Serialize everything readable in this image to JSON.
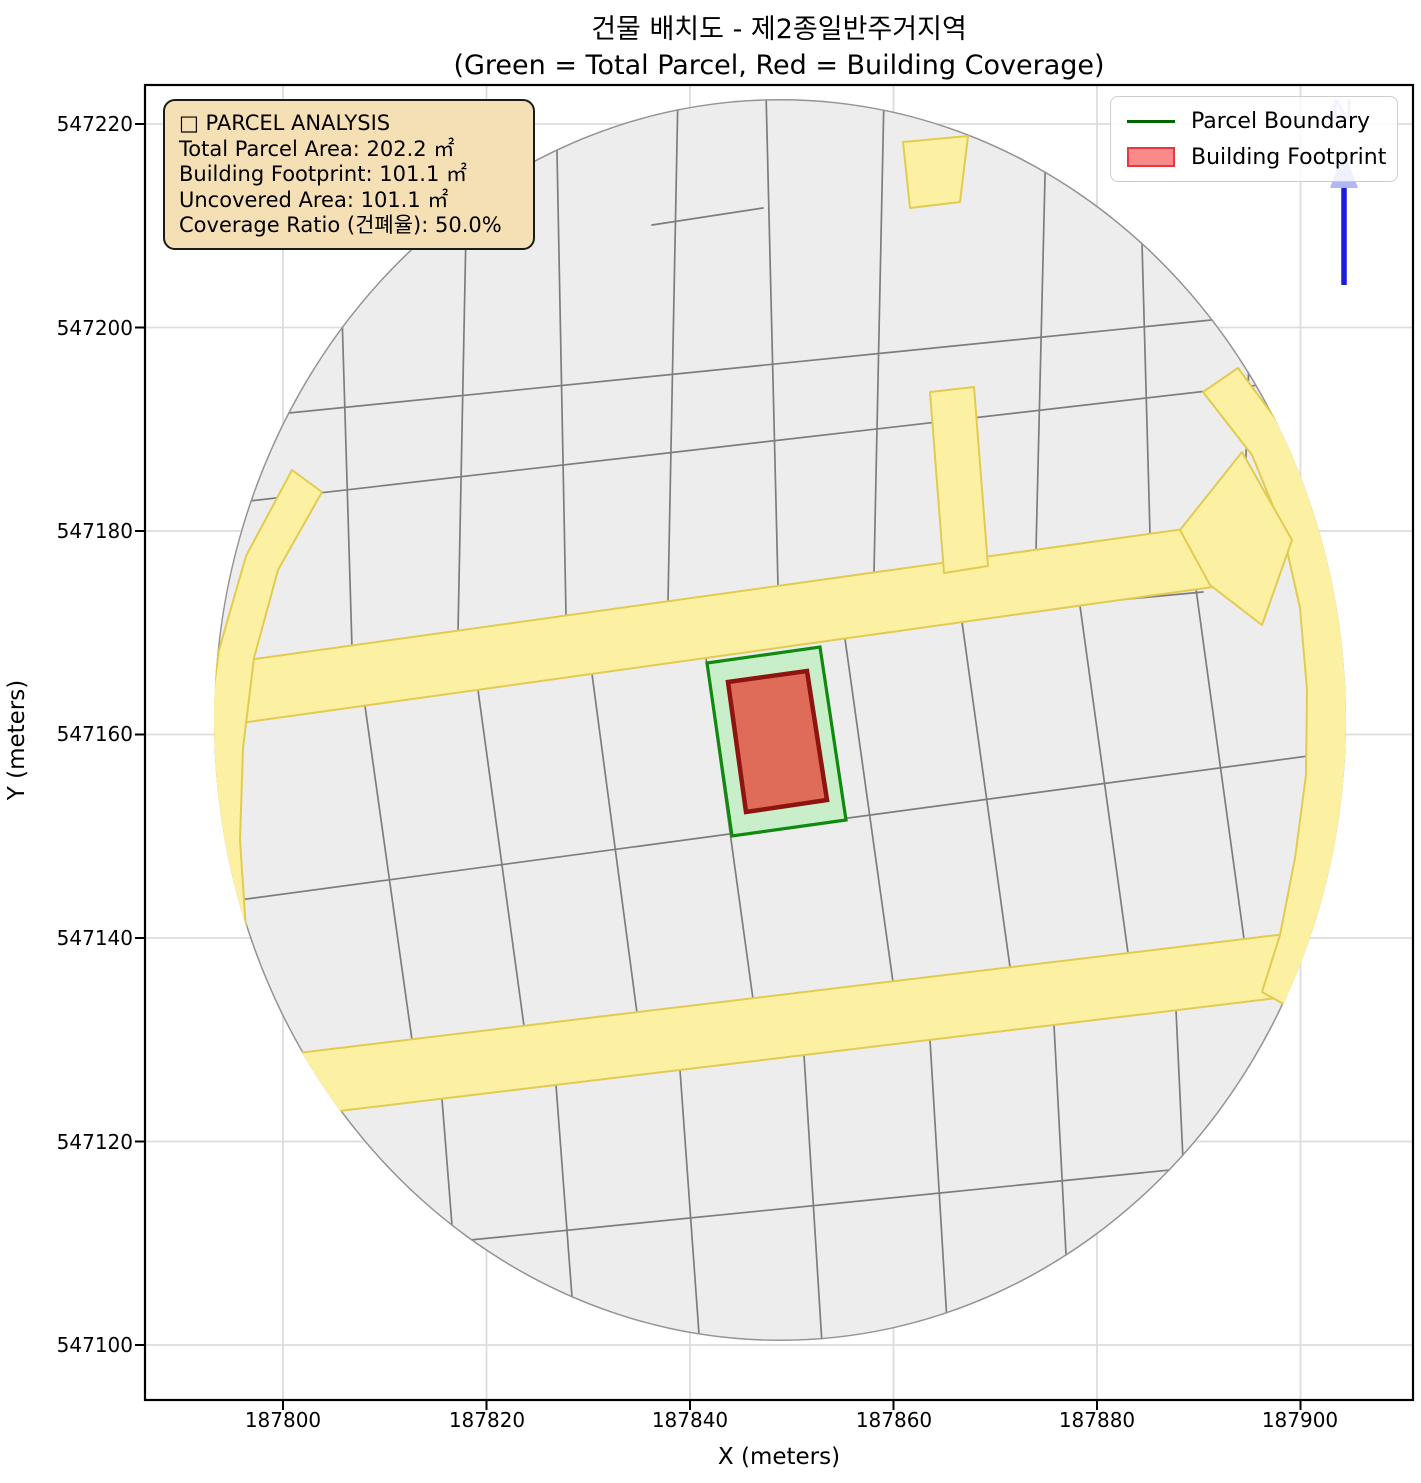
{
  "figure": {
    "title_line1": "건물 배치도 - 제2종일반주거지역",
    "title_line2": "(Green = Total Parcel, Red = Building Coverage)"
  },
  "info_box": {
    "heading": "□ PARCEL ANALYSIS",
    "rows": [
      "Total Parcel Area: 202.2 ㎡",
      "Building Footprint: 101.1 ㎡",
      "Uncovered Area: 101.1 ㎡",
      "Coverage Ratio (건폐율): 50.0%"
    ]
  },
  "analysis": {
    "total_parcel_area_m2": 202.2,
    "building_footprint_m2": 101.1,
    "uncovered_area_m2": 101.1,
    "coverage_ratio_percent": 50.0,
    "zoning": "제2종일반주거지역"
  },
  "legend": {
    "items": [
      {
        "label": "Parcel Boundary",
        "swatch": "line",
        "color": "#006400"
      },
      {
        "label": "Building Footprint",
        "swatch": "patch",
        "fill": "#f98a8a",
        "edge": "#e23a3a"
      }
    ]
  },
  "north_arrow": {
    "label": "N",
    "shaft_color": "#1c1cdf",
    "head_color": "#b0b7f3"
  },
  "axes": {
    "x_label": "X (meters)",
    "y_label": "Y (meters)",
    "x_ticks": [
      "187800",
      "187820",
      "187840",
      "187860",
      "187880",
      "187900"
    ],
    "y_ticks": [
      "547220",
      "547200",
      "547180",
      "547160",
      "547140",
      "547120",
      "547100"
    ]
  },
  "map_colors": {
    "parcel_fill": "#ededed",
    "parcel_edge": "#7d7d7d",
    "boundary_edge": "#949494",
    "road_fill": "#fcf0a2",
    "road_edge": "#e2cb50",
    "selected_parcel_fill": "#c9efca",
    "selected_parcel_edge": "#0f8a0f",
    "building_fill": "#df6b59",
    "building_edge": "#8e1410",
    "gridline": "#dddddd"
  }
}
